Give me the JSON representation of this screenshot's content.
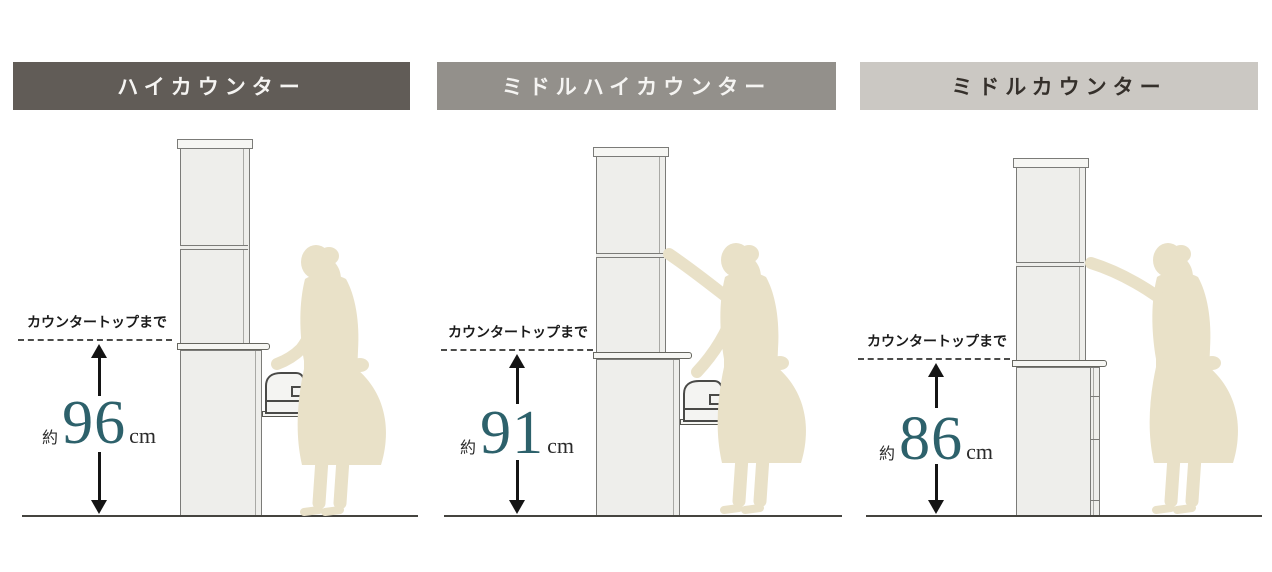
{
  "figure": "kitchen-counter-height-comparison",
  "accent_teal": "#2d616b",
  "silhouette_color": "#e9e1c8",
  "panels": [
    {
      "header": {
        "label": "ハイカウンター",
        "bg": "#615c57",
        "color": "#f5f4f2"
      },
      "measure": {
        "label": "カウンタートップまで",
        "prefix": "約",
        "value": "96",
        "unit": "cm"
      }
    },
    {
      "header": {
        "label": "ミドルハイカウンター",
        "bg": "#93908b",
        "color": "#f5f4f2"
      },
      "measure": {
        "label": "カウンタートップまで",
        "prefix": "約",
        "value": "91",
        "unit": "cm"
      }
    },
    {
      "header": {
        "label": "ミドルカウンター",
        "bg": "#cbc8c3",
        "color": "#35302b"
      },
      "measure": {
        "label": "カウンタートップまで",
        "prefix": "約",
        "value": "86",
        "unit": "cm"
      }
    }
  ]
}
